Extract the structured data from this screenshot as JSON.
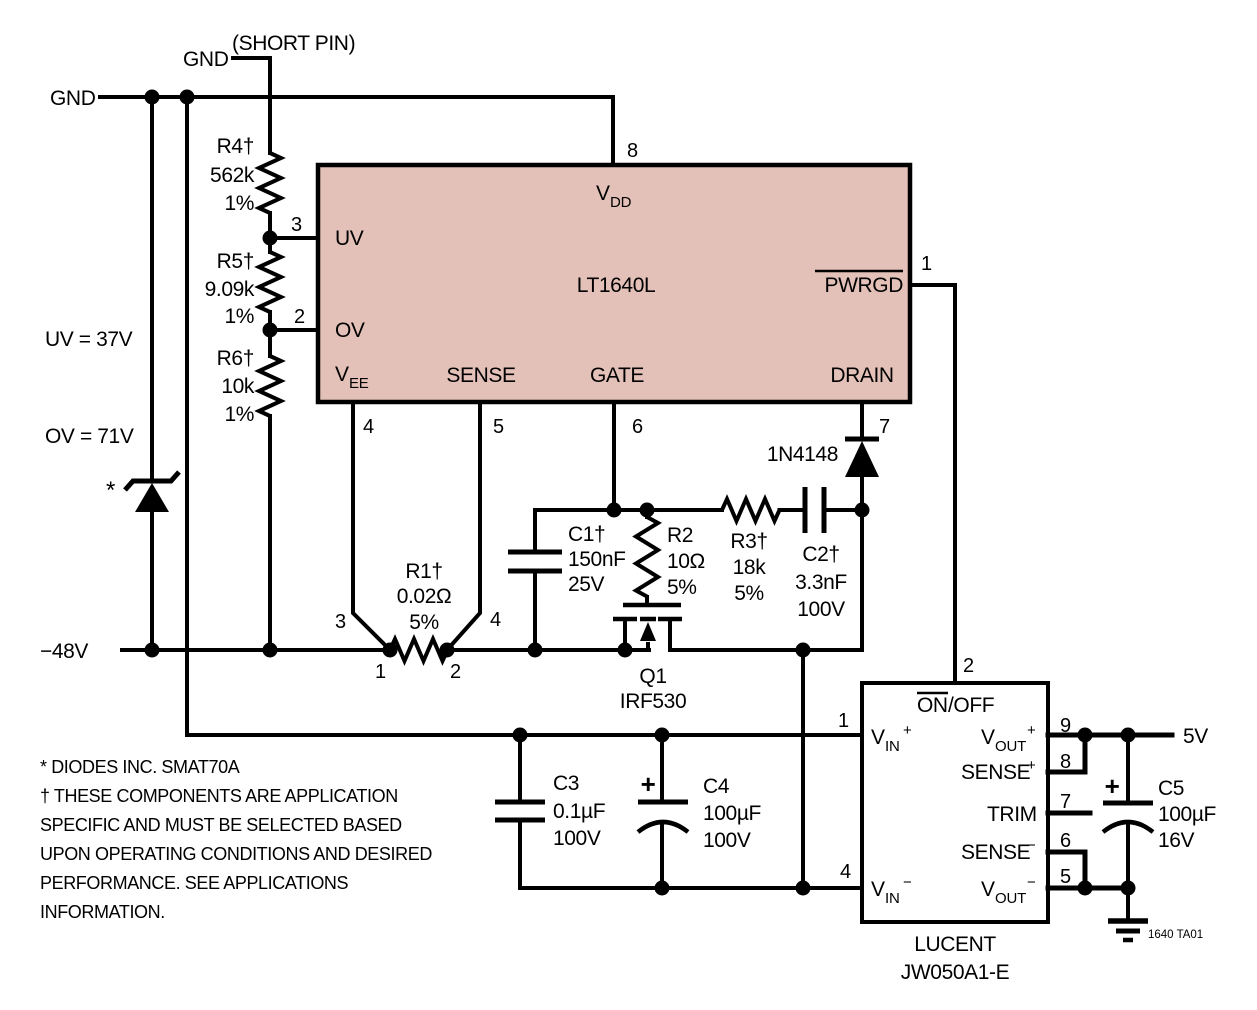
{
  "colors": {
    "ic_fill": "#e4c1b8",
    "line": "#000000",
    "background": "#ffffff"
  },
  "power": {
    "gnd_label": "GND",
    "gnd_short_label": "GND",
    "short_pin_note": "(SHORT PIN)",
    "neg48_label": "−48V",
    "v5_label": "5V",
    "uv_note": "UV = 37V",
    "ov_note": "OV = 71V"
  },
  "ic": {
    "part_number": "LT1640L",
    "pins": {
      "vdd": {
        "base": "V",
        "sub": "DD",
        "num": "8"
      },
      "uv": {
        "label": "UV",
        "num": "3"
      },
      "ov": {
        "label": "OV",
        "num": "2"
      },
      "vee": {
        "base": "V",
        "sub": "EE",
        "num": "4"
      },
      "sense": {
        "label": "SENSE",
        "num": "5"
      },
      "gate": {
        "label": "GATE",
        "num": "6"
      },
      "drain": {
        "label": "DRAIN",
        "num": "7"
      },
      "pwrgd": {
        "label": "PWRGD",
        "num": "1"
      }
    }
  },
  "components": {
    "r1": {
      "name": "R1†",
      "value": "0.02Ω",
      "tol": "5%",
      "k3": "3",
      "k4": "4",
      "t1": "1",
      "t2": "2"
    },
    "r2": {
      "name": "R2",
      "value": "10Ω",
      "tol": "5%"
    },
    "r3": {
      "name": "R3†",
      "value": "18k",
      "tol": "5%"
    },
    "r4": {
      "name": "R4†",
      "value": "562k",
      "tol": "1%"
    },
    "r5": {
      "name": "R5†",
      "value": "9.09k",
      "tol": "1%"
    },
    "r6": {
      "name": "R6†",
      "value": "10k",
      "tol": "1%"
    },
    "c1": {
      "name": "C1†",
      "value": "150nF",
      "rating": "25V"
    },
    "c2": {
      "name": "C2†",
      "value": "3.3nF",
      "rating": "100V"
    },
    "c3": {
      "name": "C3",
      "value": "0.1µF",
      "rating": "100V"
    },
    "c4": {
      "name": "C4",
      "value": "100µF",
      "rating": "100V",
      "plus": "+"
    },
    "c5": {
      "name": "C5",
      "value": "100µF",
      "rating": "16V",
      "plus": "+"
    },
    "q1": {
      "name": "Q1",
      "part": "IRF530"
    },
    "d1": {
      "part": "1N4148"
    },
    "zener": {
      "marker": "*"
    }
  },
  "module": {
    "vendor": "LUCENT",
    "part": "JW050A1-E",
    "pins": {
      "on_off": {
        "on": "ON",
        "off": "/OFF",
        "num": "2"
      },
      "vin_p": {
        "base": "V",
        "sub": "IN",
        "sup": "+",
        "num": "1"
      },
      "vin_m": {
        "base": "V",
        "sub": "IN",
        "sup": "−",
        "num": "4"
      },
      "vout_p": {
        "base": "V",
        "sub": "OUT",
        "sup": "+",
        "num": "9"
      },
      "sense_p": {
        "base": "SENSE",
        "sup": "+",
        "num": "8"
      },
      "trim": {
        "label": "TRIM",
        "num": "7"
      },
      "sense_m": {
        "base": "SENSE",
        "sup": "−",
        "num": "6"
      },
      "vout_m": {
        "base": "V",
        "sub": "OUT",
        "sup": "−",
        "num": "5"
      }
    }
  },
  "notes": {
    "l1": "* DIODES INC. SMAT70A",
    "l2": "† THESE COMPONENTS ARE APPLICATION",
    "l3": "SPECIFIC AND MUST BE SELECTED BASED",
    "l4": "UPON OPERATING CONDITIONS AND DESIRED",
    "l5": "PERFORMANCE. SEE APPLICATIONS",
    "l6": "INFORMATION."
  },
  "figure_id": "1640 TA01"
}
